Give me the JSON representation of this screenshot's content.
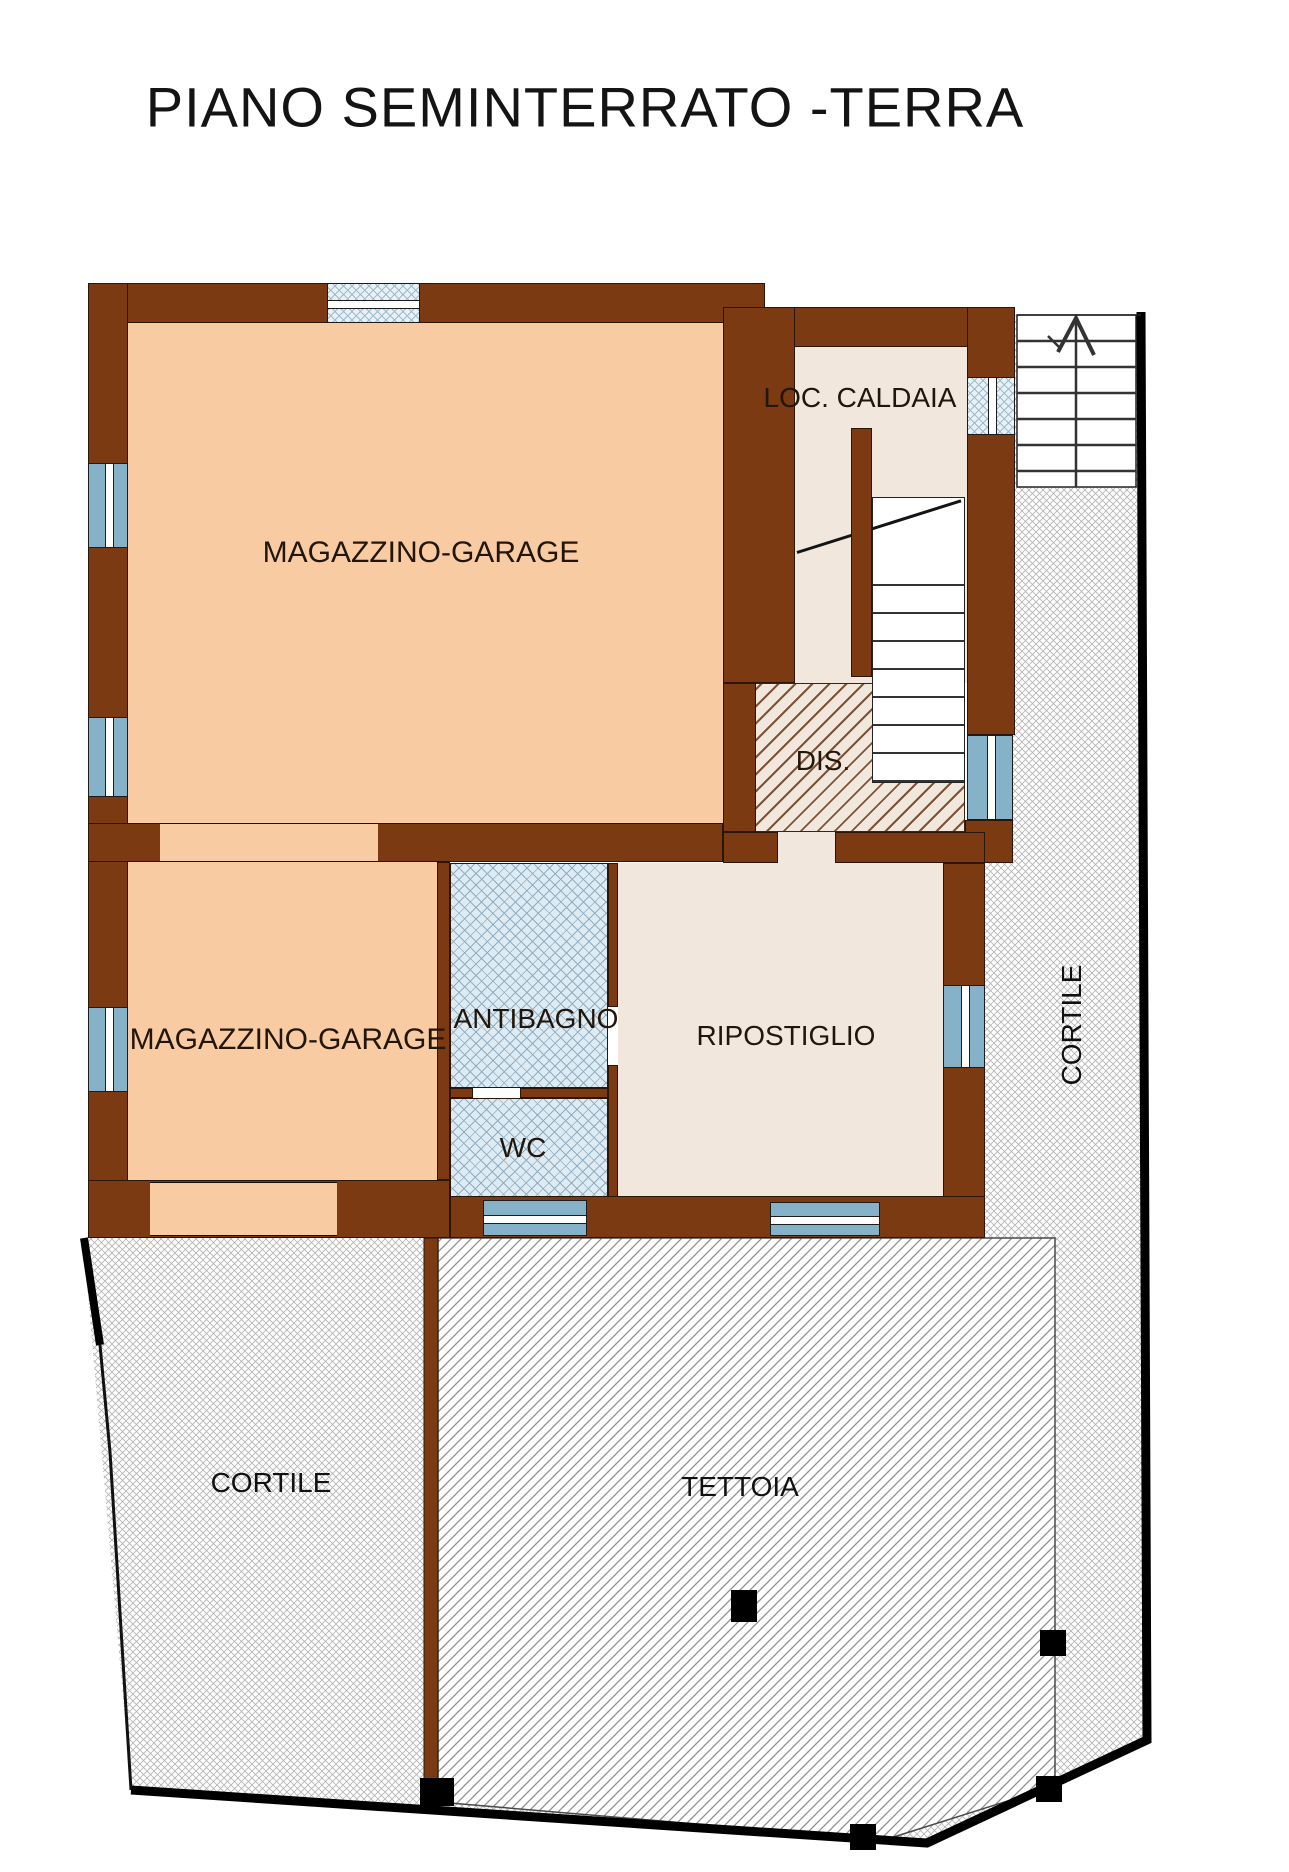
{
  "title": "PIANO SEMINTERRATO -TERRA",
  "rooms": {
    "magazzino_garage_1": "MAGAZZINO-GARAGE",
    "loc_caldaia": "LOC. CALDAIA",
    "dis": "DIS.",
    "magazzino_garage_2": "MAGAZZINO-GARAGE",
    "antibagno": "ANTIBAGNO",
    "wc": "WC",
    "ripostiglio": "RIPOSTIGLIO",
    "cortile_right": "CORTILE",
    "cortile_bottom": "CORTILE",
    "tettoia": "TETTOIA"
  },
  "symbols": {
    "stairs_direction_arrow": "up",
    "pillar": "black-square"
  },
  "colors": {
    "wall": "#7B3A11",
    "garage_floor": "#F8CBA3",
    "service_floor": "#F1E7DC",
    "window": "#86B2C9",
    "bath_floor_hatch": "#DEEBF3",
    "site_boundary": "#000000"
  }
}
